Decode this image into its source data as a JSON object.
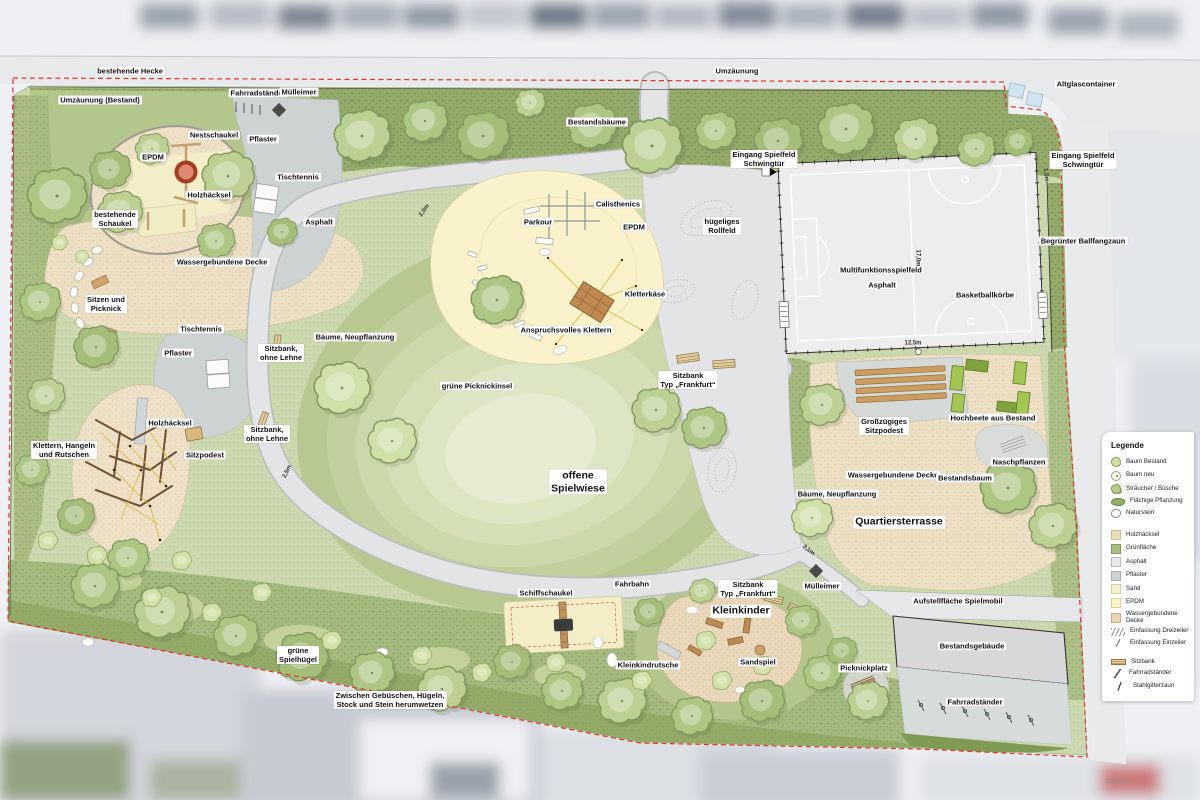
{
  "map": {
    "date_label": "28.06.21"
  },
  "legend": {
    "title": "Legende",
    "items": [
      {
        "label": "Baum Bestand",
        "icon": "sw-baum-bestand"
      },
      {
        "label": "Baum neu",
        "icon": "sw-baum-neu"
      },
      {
        "label": "Sträucher / Büsche",
        "icon": "sw-straeucher"
      },
      {
        "label": "Flächige Pflanzung",
        "icon": "sw-flaechige"
      },
      {
        "label": "Naturstein",
        "icon": "sw-naturstein"
      },
      {
        "label": "Holzhäcksel",
        "icon": "sw-holz",
        "gap": true
      },
      {
        "label": "Grünfläche",
        "icon": "sw-gruen"
      },
      {
        "label": "Asphalt",
        "icon": "sw-asphalt"
      },
      {
        "label": "Pflaster",
        "icon": "sw-pflaster"
      },
      {
        "label": "Sand",
        "icon": "sw-sand"
      },
      {
        "label": "EPDM",
        "icon": "sw-epdm"
      },
      {
        "label": "Wassergebundene Decke",
        "icon": "sw-wgd"
      },
      {
        "label": "Einfassung Dreizeiler",
        "icon": "sw-einf3"
      },
      {
        "label": "Einfassung Einzeiler",
        "icon": "sw-einf1"
      },
      {
        "label": "Sitzbank",
        "icon": "sw-sitzbank",
        "gap": true
      },
      {
        "label": "Fahrradständer",
        "icon": "sw-fahrrad"
      },
      {
        "label": "Stahlgitterzaun",
        "icon": "sw-zaun"
      }
    ]
  },
  "labels": [
    {
      "text": "bestehende Hecke",
      "x": 130,
      "y": 71
    },
    {
      "text": "Umzäunung",
      "x": 737,
      "y": 71
    },
    {
      "text": "Umzäunung (Bestand)",
      "x": 100,
      "y": 100
    },
    {
      "text": "Fahrradständer",
      "x": 258,
      "y": 93
    },
    {
      "text": "Mülleimer",
      "x": 299,
      "y": 92
    },
    {
      "text": "Altglascontainer",
      "x": 1086,
      "y": 84
    },
    {
      "text": "Nestschaukel",
      "x": 214,
      "y": 135
    },
    {
      "text": "Pflaster",
      "x": 263,
      "y": 139
    },
    {
      "text": "EPDM",
      "x": 153,
      "y": 157
    },
    {
      "text": "Bestandsbäume",
      "x": 597,
      "y": 122
    },
    {
      "text": "Eingang Spielfeld\nSchwingtür",
      "x": 764,
      "y": 159
    },
    {
      "text": "Eingang Spielfeld\nSchwingtür",
      "x": 1083,
      "y": 160
    },
    {
      "text": "Tischtennis",
      "x": 298,
      "y": 177
    },
    {
      "text": "Holzhäcksel",
      "x": 209,
      "y": 195
    },
    {
      "text": "bestehende\nSchaukel",
      "x": 115,
      "y": 219
    },
    {
      "text": "Asphalt",
      "x": 319,
      "y": 222
    },
    {
      "text": "Calisthenics",
      "x": 618,
      "y": 204
    },
    {
      "text": "Parkour",
      "x": 538,
      "y": 222
    },
    {
      "text": "EPDM",
      "x": 634,
      "y": 227
    },
    {
      "text": "hügeliges\nRollfeld",
      "x": 722,
      "y": 226
    },
    {
      "text": "Begrünter Ballfangzaun",
      "x": 1083,
      "y": 241
    },
    {
      "text": "Multifunktionsspielfeld",
      "x": 881,
      "y": 270
    },
    {
      "text": "Asphalt",
      "x": 882,
      "y": 285
    },
    {
      "text": "Basketballkörbe",
      "x": 985,
      "y": 295
    },
    {
      "text": "Wassergebundene Decke",
      "x": 222,
      "y": 262
    },
    {
      "text": "Sitzen und\nPicknick",
      "x": 106,
      "y": 304
    },
    {
      "text": "Kletterkäse",
      "x": 645,
      "y": 294
    },
    {
      "text": "Tischtennis",
      "x": 201,
      "y": 329
    },
    {
      "text": "Anspruchsvolles Klettern",
      "x": 566,
      "y": 330
    },
    {
      "text": "Bäume, Neupflanzung",
      "x": 355,
      "y": 337
    },
    {
      "text": "Pflaster",
      "x": 178,
      "y": 353
    },
    {
      "text": "Sitzbank,\nohne Lehne",
      "x": 281,
      "y": 353
    },
    {
      "text": "grüne Picknickinsel",
      "x": 477,
      "y": 386
    },
    {
      "text": "Sitzbank\nTyp „Frankfurt“",
      "x": 688,
      "y": 380
    },
    {
      "text": "Holzhäcksel",
      "x": 170,
      "y": 423
    },
    {
      "text": "Sitzbank,\nohne Lehne",
      "x": 267,
      "y": 434
    },
    {
      "text": "Klettern, Hangeln\nund Rutschen",
      "x": 64,
      "y": 450
    },
    {
      "text": "Sitzpodest",
      "x": 205,
      "y": 455
    },
    {
      "text": "Großzügiges\nSitzpodest",
      "x": 884,
      "y": 426
    },
    {
      "text": "Hochbeete aus Bestand",
      "x": 993,
      "y": 418
    },
    {
      "text": "Naschpflanzen",
      "x": 1019,
      "y": 462
    },
    {
      "text": "offene\nSpielwiese",
      "x": 578,
      "y": 482,
      "size": "l"
    },
    {
      "text": "Wassergebundene Decke",
      "x": 893,
      "y": 475
    },
    {
      "text": "Bestandsbaum",
      "x": 965,
      "y": 478
    },
    {
      "text": "Bäume, Neupflanzung",
      "x": 837,
      "y": 494
    },
    {
      "text": "Quartiersterrasse",
      "x": 899,
      "y": 522,
      "size": "l"
    },
    {
      "text": "Fahrbahn",
      "x": 632,
      "y": 584
    },
    {
      "text": "Schiffschaukel",
      "x": 546,
      "y": 593
    },
    {
      "text": "Sitzbank\nTyp „Frankfurt“",
      "x": 748,
      "y": 589
    },
    {
      "text": "Mülleimer",
      "x": 822,
      "y": 586
    },
    {
      "text": "Aufstellfläche Spielmobil",
      "x": 958,
      "y": 601
    },
    {
      "text": "Kleinkinder",
      "x": 741,
      "y": 611,
      "size": "l"
    },
    {
      "text": "Bestandsgebäude",
      "x": 972,
      "y": 646
    },
    {
      "text": "Kleinkindrutsche",
      "x": 648,
      "y": 665
    },
    {
      "text": "Sandspiel",
      "x": 758,
      "y": 662
    },
    {
      "text": "Picknickplatz",
      "x": 864,
      "y": 668
    },
    {
      "text": "grüne\nSpielhügel",
      "x": 298,
      "y": 655
    },
    {
      "text": "Zwischen Gebüschen, Hügeln,\nStock und Stein herumwetzen",
      "x": 390,
      "y": 700
    },
    {
      "text": "Fahrradständer",
      "x": 975,
      "y": 702
    },
    {
      "text": "2,0m",
      "x": 425,
      "y": 211,
      "size": "dim",
      "rot": -55
    },
    {
      "text": "17,0m",
      "x": 917,
      "y": 258,
      "size": "dim",
      "rot": 90
    },
    {
      "text": "12,5m",
      "x": 913,
      "y": 344,
      "size": "dim"
    },
    {
      "text": "2,5m",
      "x": 288,
      "y": 472,
      "size": "dim",
      "rot": -65
    },
    {
      "text": "2,1m",
      "x": 808,
      "y": 551,
      "size": "dim",
      "rot": 38
    },
    {
      "text": "1,5m",
      "x": 1045,
      "y": 175,
      "size": "dim",
      "rot": 85
    }
  ]
}
